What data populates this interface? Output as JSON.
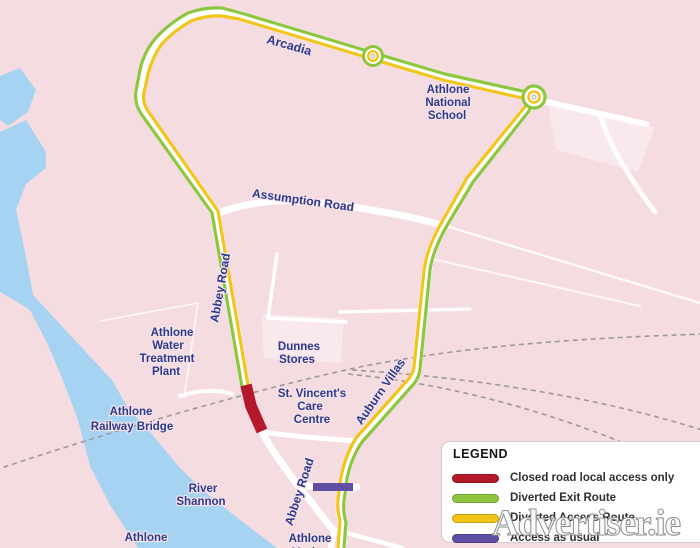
{
  "colors": {
    "background": "#f5dce1",
    "water": "#a7d3f2",
    "road": "#ffffff",
    "label": "#2c3a8e",
    "railway": "#9a9a9a",
    "closed_red": "#b5182b",
    "exit_green": "#8dc63f",
    "access_yellow": "#f2c51a",
    "usual_purple": "#5f4ea3"
  },
  "map_labels": [
    {
      "text": "Arcadia"
    },
    {
      "text": "Athlone"
    },
    {
      "text": "National"
    },
    {
      "text": "School"
    },
    {
      "text": "Assumption Road"
    },
    {
      "text": "Abbey Road"
    },
    {
      "text": "Athlone"
    },
    {
      "text": "Water"
    },
    {
      "text": "Treatment"
    },
    {
      "text": "Plant"
    },
    {
      "text": "Dunnes"
    },
    {
      "text": "Stores"
    },
    {
      "text": "St. Vincent's"
    },
    {
      "text": "Care"
    },
    {
      "text": "Centre"
    },
    {
      "text": "Athlone"
    },
    {
      "text": "Railway Bridge"
    },
    {
      "text": "Auburn Villas"
    },
    {
      "text": "River"
    },
    {
      "text": "Shannon"
    },
    {
      "text": "Athlone"
    },
    {
      "text": "Abbey Road"
    },
    {
      "text": "Athlone"
    },
    {
      "text": "Marina"
    }
  ],
  "legend": {
    "title": "LEGEND",
    "items": [
      {
        "label": "Closed road local access only",
        "color": "#b5182b"
      },
      {
        "label": "Diverted Exit Route",
        "color": "#8dc63f"
      },
      {
        "label": "Diverted Access Route",
        "color": "#f2c51a"
      },
      {
        "label": "Access as usual",
        "color": "#5f4ea3"
      }
    ]
  },
  "watermark": {
    "text": "Advertiser.ie"
  }
}
